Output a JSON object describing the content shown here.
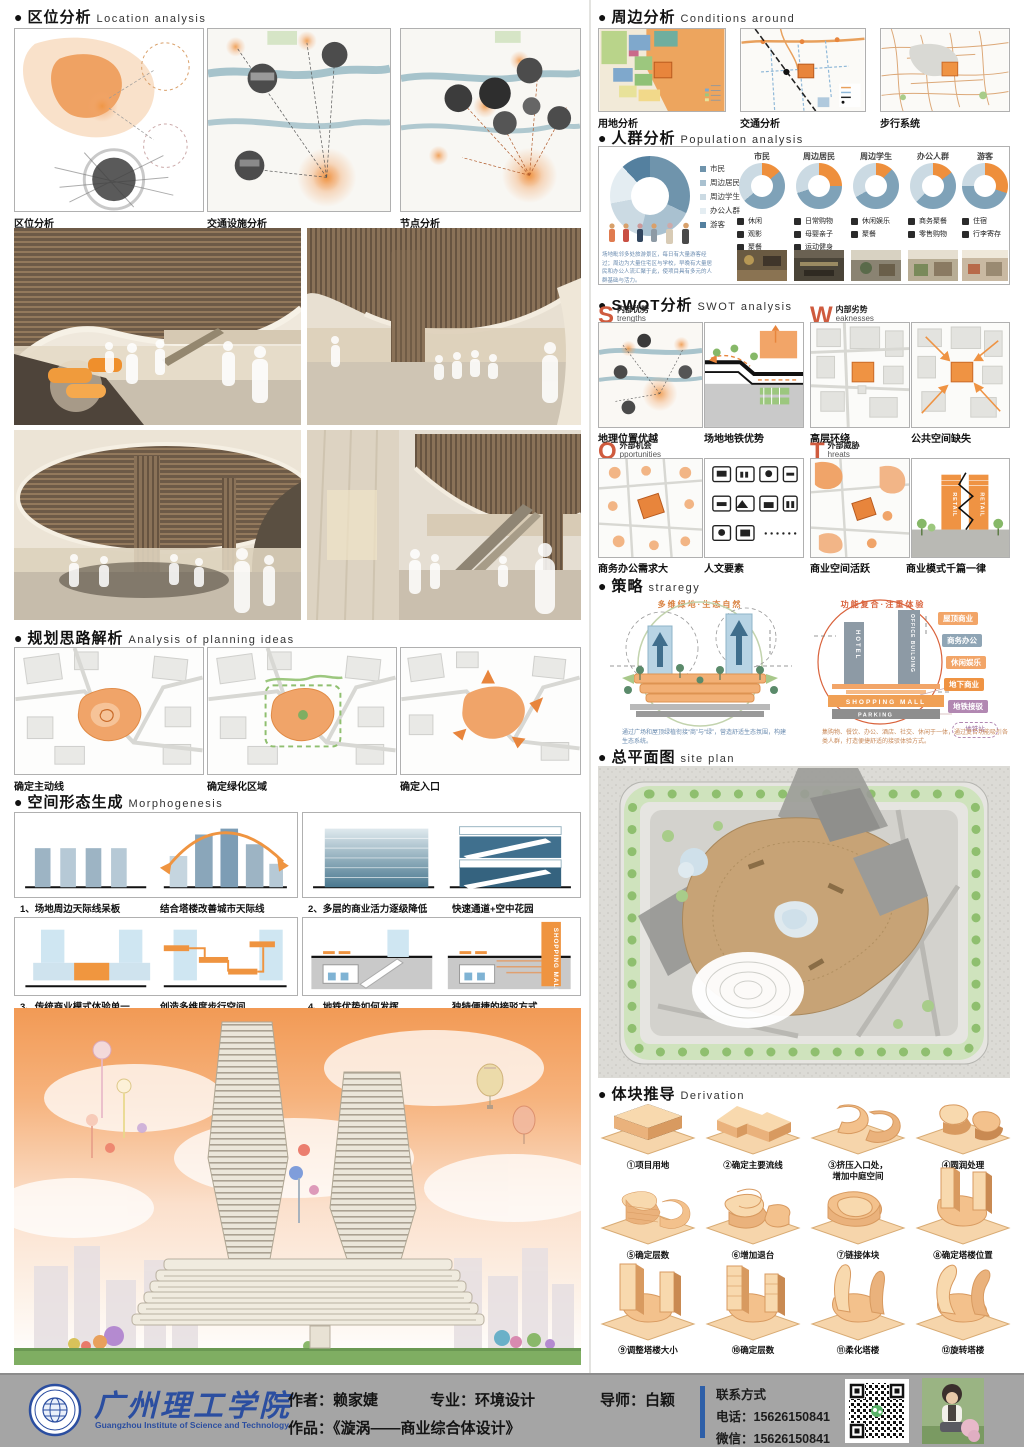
{
  "ui": {
    "bullet": "●"
  },
  "colors": {
    "accent_orange": "#ee8f3c",
    "river_blue": "#9cbcc6",
    "footer_gray": "#a5a5a5",
    "school_blue": "#2b4ea0",
    "swot_letter": "#cf5b3e"
  },
  "sections": {
    "location": {
      "title": "区位分析",
      "subtitle": "Location analysis",
      "captions": [
        "区位分析",
        "交通设施分析",
        "节点分析"
      ]
    },
    "conditions": {
      "title": "周边分析",
      "subtitle": "Conditions around",
      "captions": [
        "用地分析",
        "交通分析",
        "步行系统"
      ]
    },
    "population": {
      "title": "人群分析",
      "subtitle": "Population analysis",
      "legend": [
        "市民",
        "周边居民",
        "周边学生",
        "办公人群",
        "游客"
      ],
      "main_donut": [
        {
          "label": "市民",
          "value": 32,
          "color": "#6f94ac"
        },
        {
          "label": "周边居民",
          "value": 22,
          "color": "#a9c1d0"
        },
        {
          "label": "周边学生",
          "value": 18,
          "color": "#cbdae3"
        },
        {
          "label": "办公人群",
          "value": 16,
          "color": "#e4edf2"
        },
        {
          "label": "游客",
          "value": 12,
          "color": "#54809f"
        }
      ],
      "donuts": [
        {
          "title": "市民",
          "segments": [
            {
              "value": 14,
              "color": "#ee8f3c"
            },
            {
              "value": 50,
              "color": "#7fa2b8"
            },
            {
              "value": 36,
              "color": "#cbdae3"
            }
          ],
          "needs": [
            "休闲",
            "观影",
            "聚餐"
          ]
        },
        {
          "title": "周边居民",
          "segments": [
            {
              "value": 25,
              "color": "#ee8f3c"
            },
            {
              "value": 45,
              "color": "#7fa2b8"
            },
            {
              "value": 30,
              "color": "#cbdae3"
            }
          ],
          "needs": [
            "日常购物",
            "母婴亲子",
            "运动健身"
          ]
        },
        {
          "title": "周边学生",
          "segments": [
            {
              "value": 12,
              "color": "#ee8f3c"
            },
            {
              "value": 55,
              "color": "#7fa2b8"
            },
            {
              "value": 33,
              "color": "#cbdae3"
            }
          ],
          "needs": [
            "休闲娱乐",
            "聚餐"
          ]
        },
        {
          "title": "办公人群",
          "segments": [
            {
              "value": 15,
              "color": "#ee8f3c"
            },
            {
              "value": 48,
              "color": "#7fa2b8"
            },
            {
              "value": 37,
              "color": "#cbdae3"
            }
          ],
          "needs": [
            "商务聚餐",
            "零售购物"
          ]
        },
        {
          "title": "游客",
          "segments": [
            {
              "value": 30,
              "color": "#ee8f3c"
            },
            {
              "value": 45,
              "color": "#7fa2b8"
            },
            {
              "value": 25,
              "color": "#cbdae3"
            }
          ],
          "needs": [
            "住宿",
            "行李寄存"
          ]
        }
      ],
      "note": "场地毗邻多处旅游景区，每日有大量游客经过；周边为大量住宅区与学校，早晚有大量居民和办公人流汇聚于此，使项目具有多元的人群基础与活力。"
    },
    "swot": {
      "title": "SWOT分析",
      "subtitle": "SWOT analysis",
      "retail_label": "RETAIL",
      "quadrants": [
        {
          "letter": "S",
          "cn": "内部优势",
          "en": "trengths",
          "captions": [
            "地理位置优越",
            "场地地铁优势"
          ]
        },
        {
          "letter": "W",
          "cn": "内部劣势",
          "en": "eaknesses",
          "captions": [
            "高层环绕",
            "公共空间缺失"
          ]
        },
        {
          "letter": "O",
          "cn": "外部机会",
          "en": "pportunities",
          "captions": [
            "商务办公需求大",
            "人文要素"
          ]
        },
        {
          "letter": "T",
          "cn": "外部威胁",
          "en": "hreats",
          "captions": [
            "商业空间活跃",
            "商业模式千篇一律"
          ]
        }
      ]
    },
    "strategy": {
      "title": "策略",
      "subtitle": "straregy",
      "left_title": "多维绿地·生态自然",
      "right_title": "功能复合·注重体验",
      "left_note": "通过广场和屋顶绿植衔接“商”与“绿”，营造舒适生态氛围，构建生态系统。",
      "right_note": "集购物、餐饮、办公、酒店、社交、休闲于一体，通过复合功能吸引各类人群，打造便捷舒适的接驳体验方式。",
      "buildings": {
        "hotel": "HOTEL",
        "office": "OFFICE BUILDING",
        "mall": "SHOPPING MALL",
        "parking": "PARKING"
      },
      "tags": [
        "屋顶商业",
        "商务办公",
        "休闲娱乐",
        "地下商业",
        "地铁接驳"
      ],
      "station": "地铁站"
    },
    "siteplan": {
      "title": "总平面图",
      "subtitle": "site plan"
    },
    "planning": {
      "title": "规划思路解析",
      "subtitle": "Analysis of planning ideas",
      "captions": [
        "确定主动线",
        "确定绿化区域",
        "确定入口"
      ]
    },
    "morphogenesis": {
      "title": "空间形态生成",
      "subtitle": "Morphogenesis",
      "mall_label": "SHOPPING MALL",
      "captions": [
        [
          "1、场地周边天际线呆板",
          "结合塔楼改善城市天际线"
        ],
        [
          "2、多层的商业活力逐级降低",
          "快速通道+空中花园"
        ],
        [
          "3、传统商业模式体验单一",
          "创造多维度步行空间"
        ],
        [
          "4、地铁优势如何发挥",
          "独特便捷的接驳方式"
        ]
      ]
    },
    "derivation": {
      "title": "体块推导",
      "subtitle": "Derivation",
      "steps": [
        "①项目用地",
        "②确定主要流线",
        "③挤压入口处，\n增加中庭空间",
        "④圆润处理",
        "⑤确定层数",
        "⑥增加退台",
        "⑦链接体块",
        "⑧确定塔楼位置",
        "⑨调整塔楼大小",
        "⑩确定层数",
        "⑪柔化塔楼",
        "⑫旋转塔楼"
      ]
    }
  },
  "footer": {
    "school_cn": "广州理工学院",
    "school_en": "Guangzhou Institute of Science and Technology",
    "author": "作者：赖家婕",
    "major": "专业：环境设计",
    "advisor": "导师：白颖",
    "work": "作品：《漩涡——商业综合体设计》",
    "contact_title": "联系方式",
    "phone": "电话：15626150841",
    "wechat": "微信：15626150841"
  }
}
